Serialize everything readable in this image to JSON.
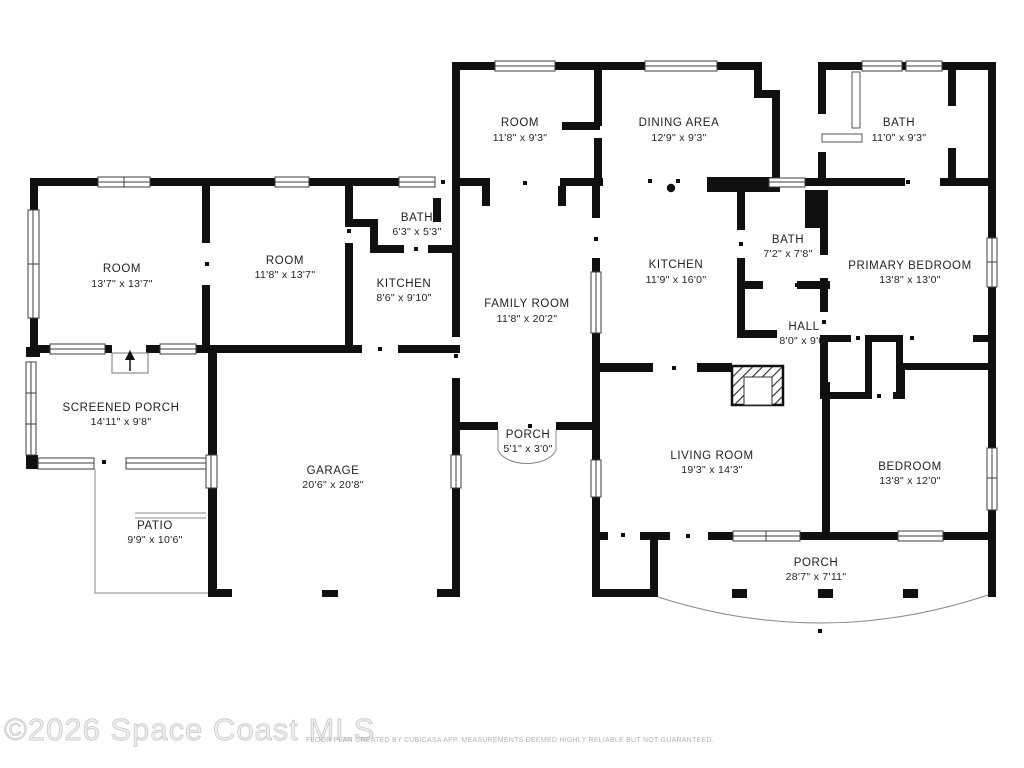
{
  "watermark": "©2026 Space Coast MLS",
  "footer": "FLOOR PLAN CREATED BY CUBICASA APP. MEASUREMENTS DEEMED HIGHLY RELIABLE BUT NOT GUARANTEED.",
  "colors": {
    "wall": "#101010",
    "window_stroke": "#3c3c3c",
    "thin_line": "#888888",
    "label": "#1f1f1f",
    "watermark": "#d9d9d9",
    "footer_text": "#b3b3b3"
  },
  "rooms": {
    "room_top": {
      "name": "ROOM",
      "dims": "11'8\" x 9'3\""
    },
    "dining_area": {
      "name": "DINING AREA",
      "dims": "12'9\" x 9'3\""
    },
    "bath_top_right": {
      "name": "BATH",
      "dims": "11'0\" x 9'3\""
    },
    "room_left": {
      "name": "ROOM",
      "dims": "13'7\" x 13'7\""
    },
    "room_mid": {
      "name": "ROOM",
      "dims": "11'8\" x 13'7\""
    },
    "bath_small": {
      "name": "BATH",
      "dims": "6'3\" x 5'3\""
    },
    "kitchen_small": {
      "name": "KITCHEN",
      "dims": "8'6\" x 9'10\""
    },
    "family_room": {
      "name": "FAMILY ROOM",
      "dims": "11'8\" x 20'2\""
    },
    "kitchen_main": {
      "name": "KITCHEN",
      "dims": "11'9\" x 16'0\""
    },
    "bath_mid": {
      "name": "BATH",
      "dims": "7'2\" x 7'8\""
    },
    "primary_bedroom": {
      "name": "PRIMARY BEDROOM",
      "dims": "13'8\" x 13'0\""
    },
    "hall": {
      "name": "HALL",
      "dims": "8'0\" x 9'0\""
    },
    "screened_porch": {
      "name": "SCREENED PORCH",
      "dims": "14'11\" x 9'8\""
    },
    "garage": {
      "name": "GARAGE",
      "dims": "20'6\" x 20'8\""
    },
    "porch_front": {
      "name": "PORCH",
      "dims": "5'1\" x 3'0\""
    },
    "living_room": {
      "name": "LIVING ROOM",
      "dims": "19'3\" x 14'3\""
    },
    "bedroom": {
      "name": "BEDROOM",
      "dims": "13'8\" x 12'0\""
    },
    "patio": {
      "name": "PATIO",
      "dims": "9'9\" x 10'6\""
    },
    "porch_back": {
      "name": "PORCH",
      "dims": "28'7\" x 7'11\""
    }
  }
}
